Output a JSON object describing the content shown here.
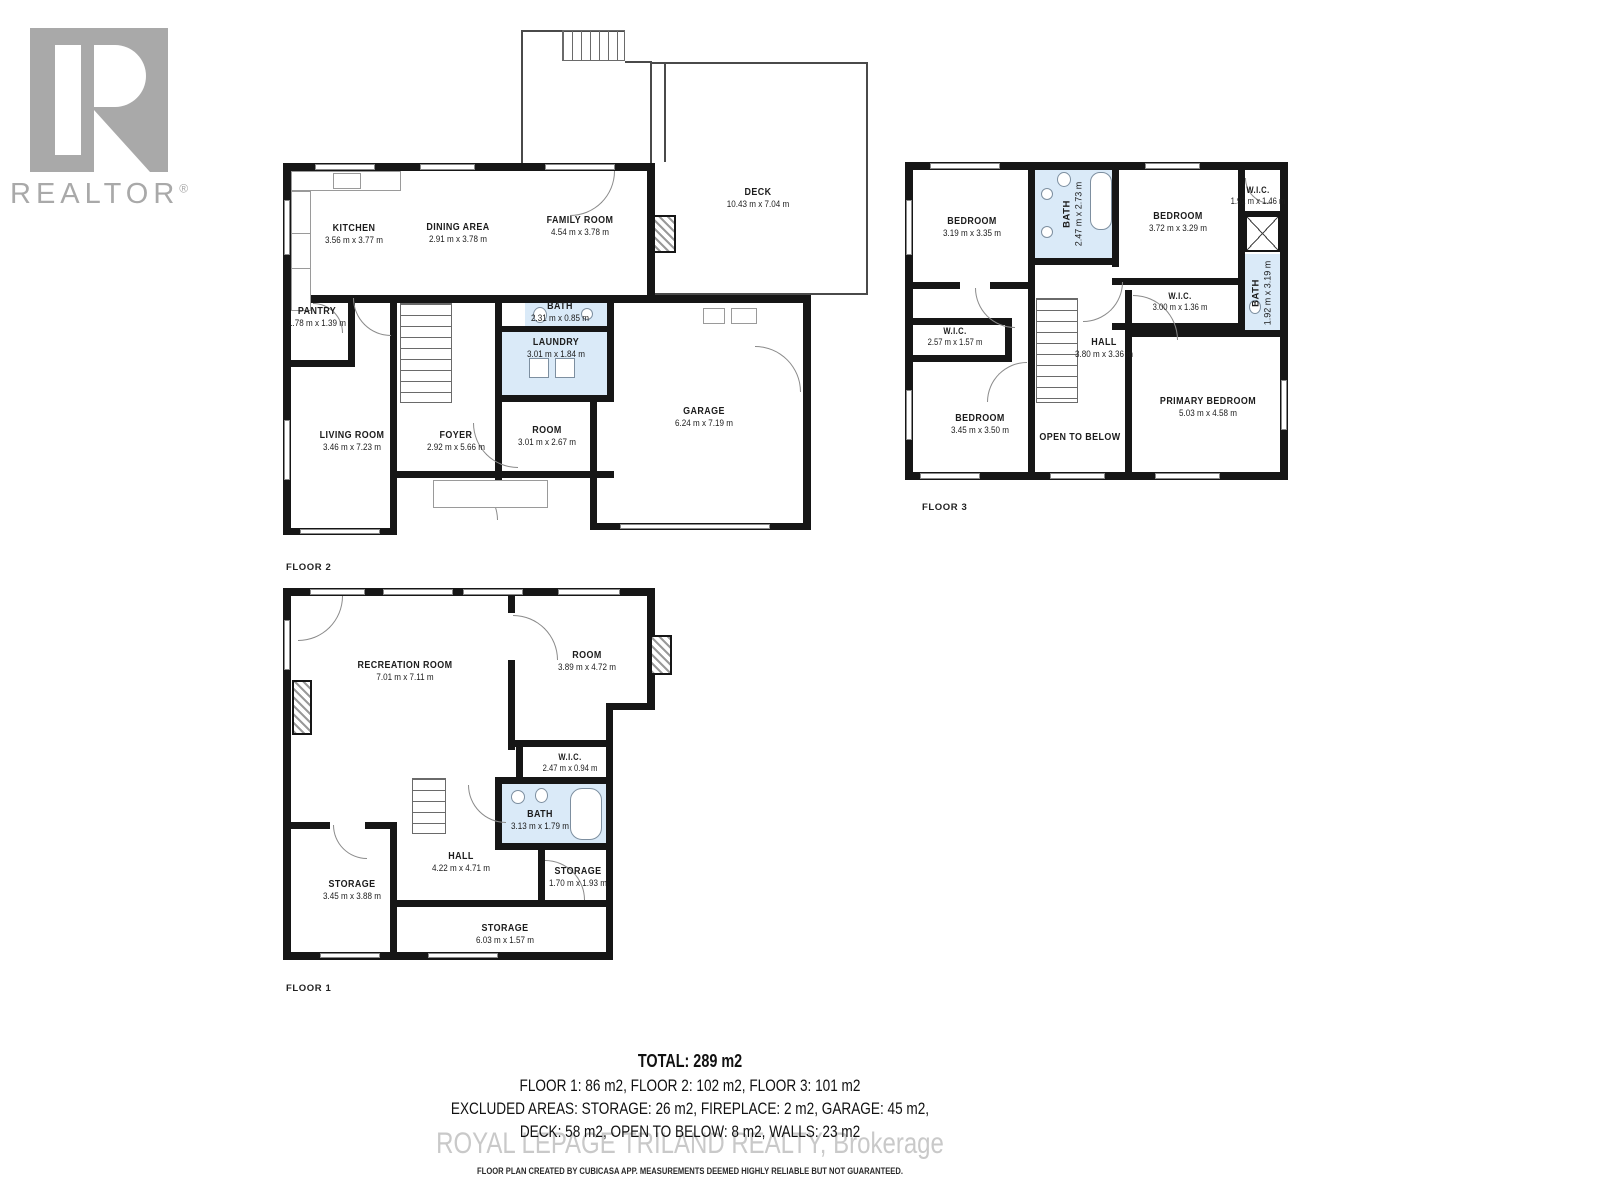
{
  "branding": {
    "realtor_text": "REALTOR",
    "registered_mark": "®",
    "watermark": "ROYAL LEPAGE TRILAND REALTY, Brokerage",
    "disclaimer": "FLOOR PLAN CREATED BY CUBICASA APP. MEASUREMENTS DEEMED HIGHLY RELIABLE BUT NOT GUARANTEED."
  },
  "summary": {
    "total": "TOTAL: 289 m2",
    "floors": "FLOOR 1: 86 m2, FLOOR 2: 102 m2, FLOOR 3: 101 m2",
    "excluded1": "EXCLUDED AREAS: STORAGE: 26 m2, FIREPLACE: 2 m2, GARAGE: 45 m2,",
    "excluded2": "DECK: 58 m2, OPEN TO BELOW: 8 m2, WALLS: 23 m2"
  },
  "colors": {
    "wall": "#161616",
    "bath_fill": "#daeaf8",
    "logo_gray": "#a9a9a9",
    "watermark_gray": "#c9c9c9"
  },
  "floor2": {
    "label": "FLOOR 2",
    "rooms": {
      "kitchen": {
        "name": "KITCHEN",
        "dims": "3.56 m x 3.77 m"
      },
      "dining": {
        "name": "DINING AREA",
        "dims": "2.91 m x 3.78 m"
      },
      "family": {
        "name": "FAMILY ROOM",
        "dims": "4.54 m x 3.78 m"
      },
      "deck": {
        "name": "DECK",
        "dims": "10.43 m x 7.04 m"
      },
      "pantry": {
        "name": "PANTRY",
        "dims": "1.78 m x 1.39 m"
      },
      "bath": {
        "name": "BATH",
        "dims": "2.31 m x 0.85 m"
      },
      "laundry": {
        "name": "LAUNDRY",
        "dims": "3.01 m x 1.84 m"
      },
      "living": {
        "name": "LIVING ROOM",
        "dims": "3.46 m x 7.23 m"
      },
      "foyer": {
        "name": "FOYER",
        "dims": "2.92 m x 5.66 m"
      },
      "room": {
        "name": "ROOM",
        "dims": "3.01 m x 2.67 m"
      },
      "garage": {
        "name": "GARAGE",
        "dims": "6.24 m x 7.19 m"
      }
    }
  },
  "floor3": {
    "label": "FLOOR 3",
    "rooms": {
      "bedroom_left": {
        "name": "BEDROOM",
        "dims": "3.19 m x 3.35 m"
      },
      "bath_top": {
        "name": "BATH",
        "dims": "2.47 m x 2.73 m"
      },
      "bedroom_right": {
        "name": "BEDROOM",
        "dims": "3.72 m x 3.29 m"
      },
      "wic_top": {
        "name": "W.I.C.",
        "dims": "1.92 m x 1.46 m"
      },
      "bath_right": {
        "name": "BATH",
        "dims": "1.92 m x 3.19 m"
      },
      "wic_mid": {
        "name": "W.I.C.",
        "dims": "3.00 m x 1.36 m"
      },
      "wic_left": {
        "name": "W.I.C.",
        "dims": "2.57 m x 1.57 m"
      },
      "hall": {
        "name": "HALL",
        "dims": "3.80 m x 3.36 m"
      },
      "bedroom_bottom": {
        "name": "BEDROOM",
        "dims": "3.45 m x 3.50 m"
      },
      "open_to_below": {
        "name": "OPEN TO BELOW"
      },
      "primary": {
        "name": "PRIMARY BEDROOM",
        "dims": "5.03 m x 4.58 m"
      }
    }
  },
  "floor1": {
    "label": "FLOOR 1",
    "rooms": {
      "recreation": {
        "name": "RECREATION ROOM",
        "dims": "7.01 m x 7.11 m"
      },
      "room": {
        "name": "ROOM",
        "dims": "3.89 m x 4.72 m"
      },
      "wic": {
        "name": "W.I.C.",
        "dims": "2.47 m x 0.94 m"
      },
      "bath": {
        "name": "BATH",
        "dims": "3.13 m x 1.79 m"
      },
      "hall": {
        "name": "HALL",
        "dims": "4.22 m x 4.71 m"
      },
      "storage_left": {
        "name": "STORAGE",
        "dims": "3.45 m x 3.88 m"
      },
      "storage_right": {
        "name": "STORAGE",
        "dims": "1.70 m x 1.93 m"
      },
      "storage_bottom": {
        "name": "STORAGE",
        "dims": "6.03 m x 1.57 m"
      }
    }
  }
}
